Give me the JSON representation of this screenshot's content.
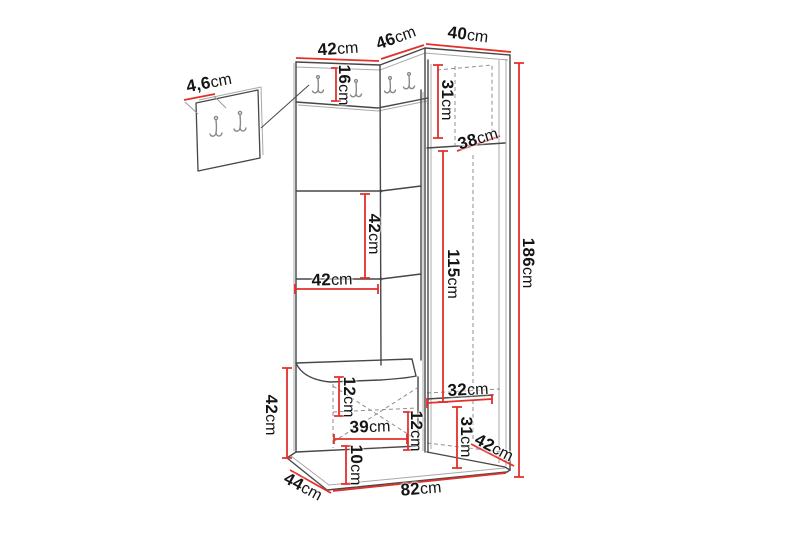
{
  "figure": {
    "type": "furniture-dimension-diagram",
    "subject": "corner hallway unit with coat hooks, bench and wardrobe cabinet",
    "unit": "cm",
    "accent_color": "#e3302b",
    "line_color": "#4a4a4a"
  },
  "dimensions": {
    "wall_panel_depth": {
      "value": "4,6",
      "unit": "cm"
    },
    "left_section_width": {
      "value": "42",
      "unit": "cm"
    },
    "corner_section_width": {
      "value": "46",
      "unit": "cm"
    },
    "right_section_width": {
      "value": "40",
      "unit": "cm"
    },
    "hook_panel_height": {
      "value": "16",
      "unit": "cm"
    },
    "cabinet_upper_height": {
      "value": "31",
      "unit": "cm"
    },
    "cabinet_top_depth": {
      "value": "38",
      "unit": "cm"
    },
    "back_panel_height": {
      "value": "42",
      "unit": "cm"
    },
    "back_panel_width": {
      "value": "42",
      "unit": "cm"
    },
    "door_height": {
      "value": "115",
      "unit": "cm"
    },
    "total_height": {
      "value": "186",
      "unit": "cm"
    },
    "bench_height": {
      "value": "42",
      "unit": "cm"
    },
    "seat_front_height": {
      "value": "12",
      "unit": "cm"
    },
    "drawer_width": {
      "value": "39",
      "unit": "cm"
    },
    "divider_height": {
      "value": "12",
      "unit": "cm"
    },
    "plinth_height": {
      "value": "10",
      "unit": "cm"
    },
    "cabinet_shelf_width": {
      "value": "32",
      "unit": "cm"
    },
    "cabinet_lower_height": {
      "value": "31",
      "unit": "cm"
    },
    "cabinet_depth": {
      "value": "42",
      "unit": "cm"
    },
    "bench_depth": {
      "value": "44",
      "unit": "cm"
    },
    "base_width": {
      "value": "82",
      "unit": "cm"
    }
  }
}
